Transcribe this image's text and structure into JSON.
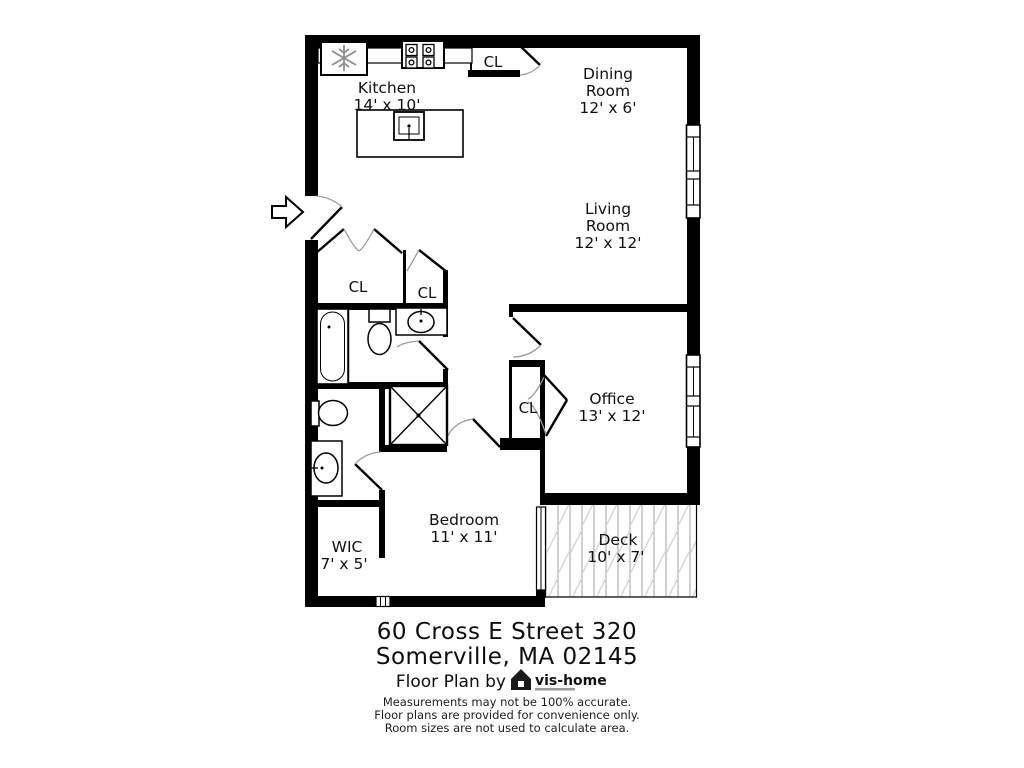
{
  "plan": {
    "labels": {
      "kitchen": {
        "line1": "Kitchen",
        "line2": "14' x 10'"
      },
      "dining": {
        "line1": "Dining",
        "line2": "Room",
        "line3": "12' x 6'"
      },
      "living": {
        "line1": "Living",
        "line2": "Room",
        "line3": "12' x 12'"
      },
      "office": {
        "line1": "Office",
        "line2": "13' x 12'"
      },
      "bedroom": {
        "line1": "Bedroom",
        "line2": "11' x 11'"
      },
      "wic": {
        "line1": "WIC",
        "line2": "7' x 5'"
      },
      "deck": {
        "line1": "Deck",
        "line2": "10' x 7'"
      },
      "closets": {
        "top": "CL",
        "hall_large": "CL",
        "hall_small": "CL",
        "office": "CL"
      }
    },
    "colors": {
      "wall": "#000000",
      "door_arc": "#9a9a9a",
      "snowflake": "#8f8f8f",
      "deck_hatch": "#c4c4c4"
    }
  },
  "footer": {
    "address_line1": "60 Cross E Street 320",
    "address_line2": "Somerville, MA 02145",
    "credit": "Floor Plan by",
    "brand": "vis-home",
    "disclaimer_line1": "Measurements may not be 100% accurate.",
    "disclaimer_line2": "Floor plans are provided for convenience only.",
    "disclaimer_line3": "Room sizes are not used to calculate area."
  }
}
